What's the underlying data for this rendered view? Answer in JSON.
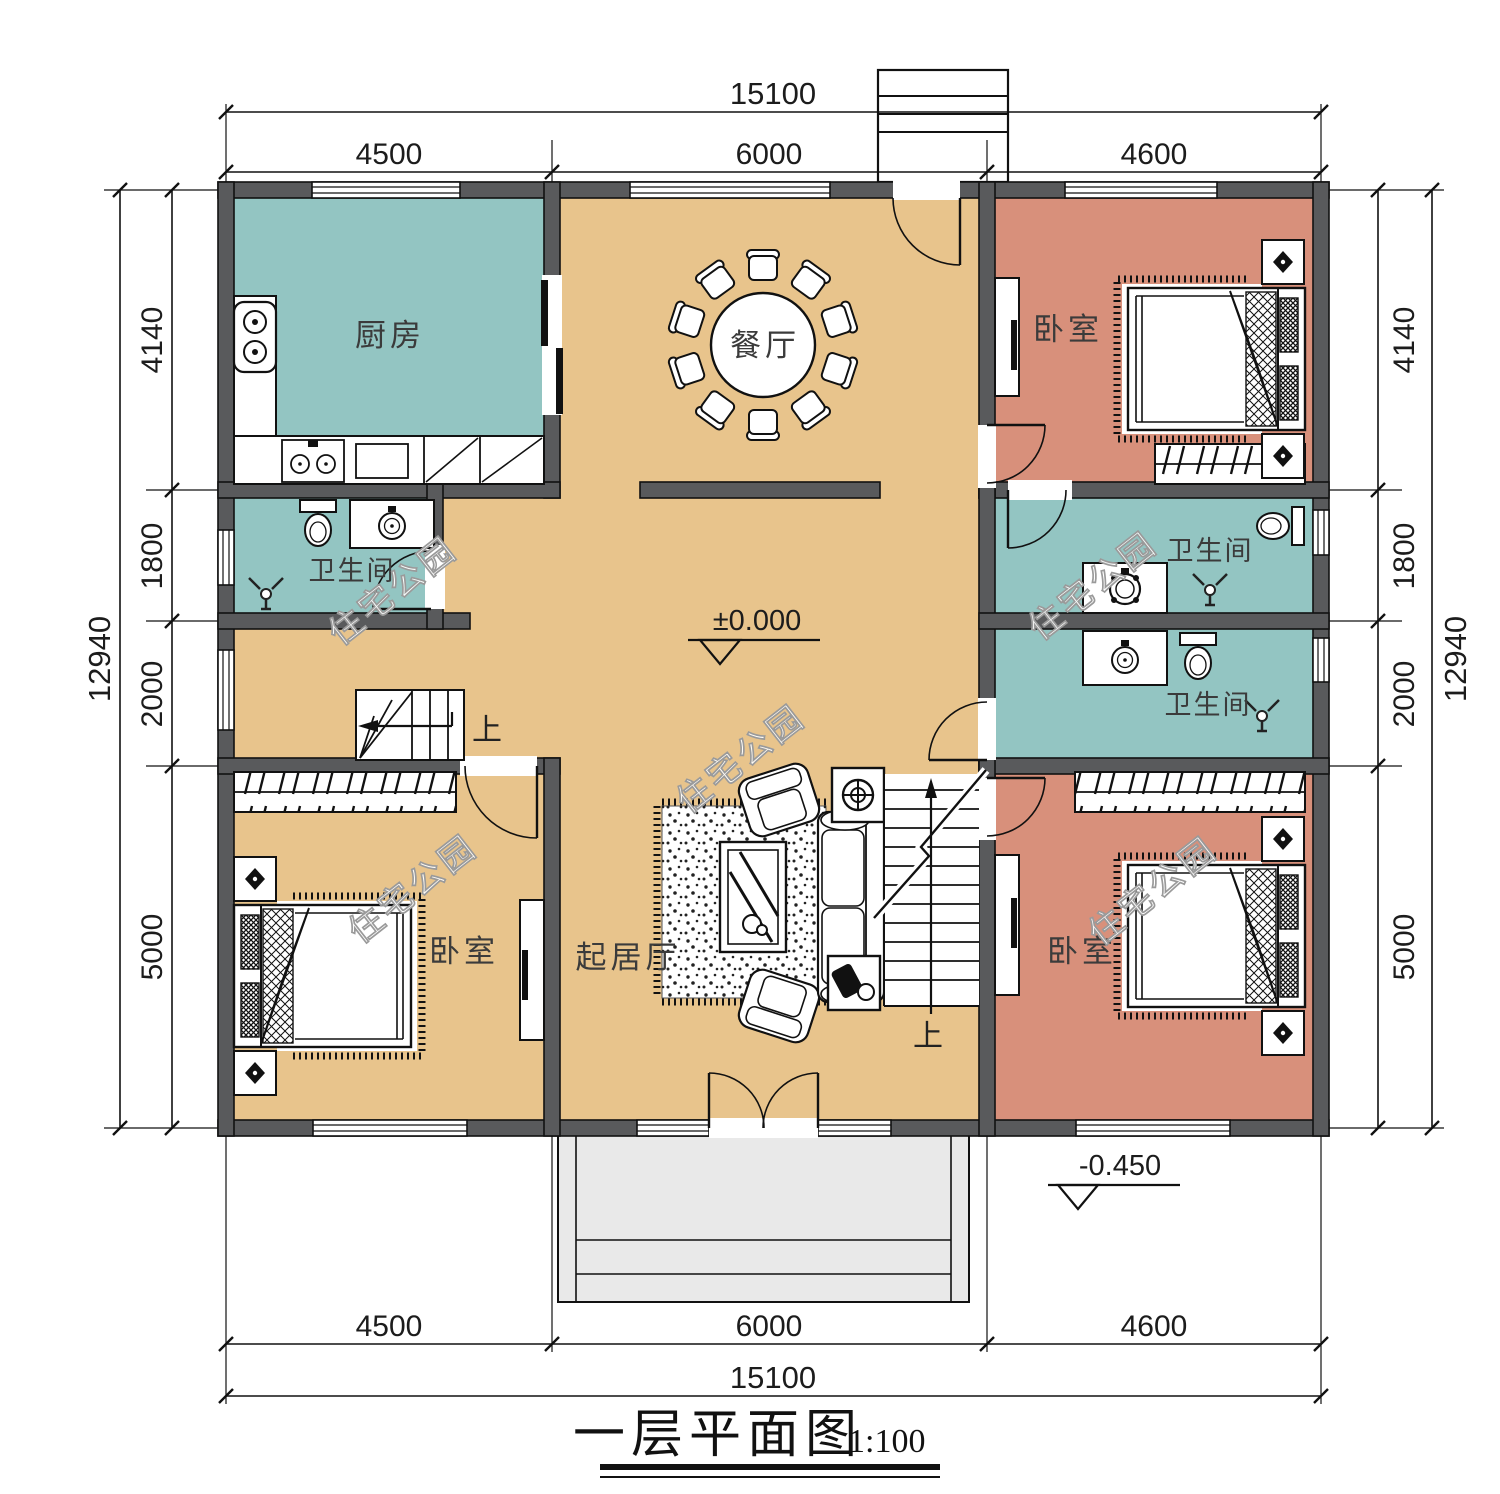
{
  "title": {
    "text": "一层平面图",
    "scale": "1:100"
  },
  "watermark": {
    "text": "住宅公园"
  },
  "levels": {
    "main": "±0.000",
    "porch": "-0.450"
  },
  "stairs": {
    "up": "上"
  },
  "rooms": {
    "kitchen": "厨房",
    "dining": "餐厅",
    "bedroom": "卧室",
    "bathroom": "卫生间",
    "living": "起居厅"
  },
  "dims": {
    "width_total": "15100",
    "height_total": "12940",
    "top": [
      "4500",
      "6000",
      "4600"
    ],
    "bottom": [
      "4500",
      "6000",
      "4600"
    ],
    "left": [
      "4140",
      "1800",
      "2000",
      "5000"
    ],
    "right": [
      "4140",
      "1800",
      "2000",
      "5000"
    ]
  },
  "colors": {
    "wall": "#595a5c",
    "floor_tan": "#e8c48c",
    "wet_teal": "#93c5c2",
    "bedroom_salmon": "#d8907b",
    "porch_gray": "#e9e9e9",
    "line": "#111111"
  }
}
